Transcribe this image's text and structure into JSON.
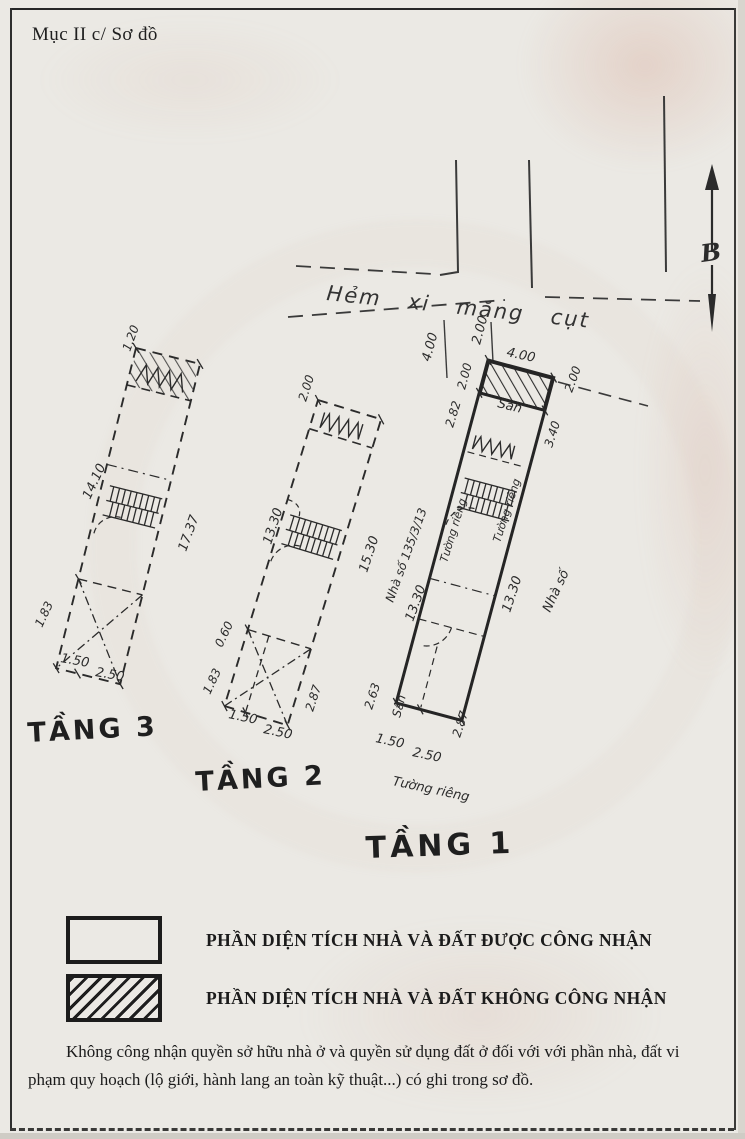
{
  "header": {
    "title": "Mục II c/ Sơ đồ"
  },
  "compass": {
    "north_label": "B"
  },
  "site": {
    "alley_label": "Hẻm xi măng cụt",
    "dim_alley_width": "4.00",
    "dim_alley_side": "2.00",
    "house_number": "Nhà số 135/3/13",
    "neighbor_label": "Nhà số"
  },
  "floor1": {
    "label": "TẦNG 1",
    "yard_top": "Sân",
    "yard_bottom": "Sân",
    "wall_left": "Tường riêng",
    "wall_right": "Tường riêng",
    "wall_bottom": "Tường riêng",
    "dim_top_width": "4.00",
    "dim_hatch_depth": "2.00",
    "dim_left_upper": "2.82",
    "dim_right_offset": "2.00",
    "dim_right_upper": "3.40",
    "dim_length_left": "13.30",
    "dim_length_right": "13.30",
    "dim_bottom_left": "2.63",
    "dim_bottom_right": "2.87",
    "dim_bottom_w1": "1.50",
    "dim_bottom_w2": "2.50"
  },
  "floor2": {
    "label": "TẦNG 2",
    "dim_top": "2.00",
    "dim_length_left": "13.30",
    "dim_length_right": "15.30",
    "dim_left_lower1": "1.83",
    "dim_left_lower2": "0.60",
    "dim_bottom_right": "2.87",
    "dim_bottom_w1": "1.50",
    "dim_bottom_w2": "2.50"
  },
  "floor3": {
    "label": "TẦNG 3",
    "dim_top": "1.20",
    "dim_length_left": "14.10",
    "dim_length_right": "17.37",
    "dim_left_lower": "1.83",
    "dim_bottom_w1": "1.50",
    "dim_bottom_w2": "2.50"
  },
  "legend": {
    "recognized": "PHẦN DIỆN TÍCH NHÀ VÀ ĐẤT ĐƯỢC CÔNG NHẬN",
    "not_recognized": "PHẦN DIỆN TÍCH NHÀ VÀ ĐẤT KHÔNG CÔNG NHẬN"
  },
  "footnote": "Không công nhận quyền sở hữu nhà ở và quyền sử dụng đất ở đối với với phần nhà, đất vi phạm quy hoạch (lộ giới, hành lang an toàn kỹ thuật...) có ghi trong sơ đồ."
}
